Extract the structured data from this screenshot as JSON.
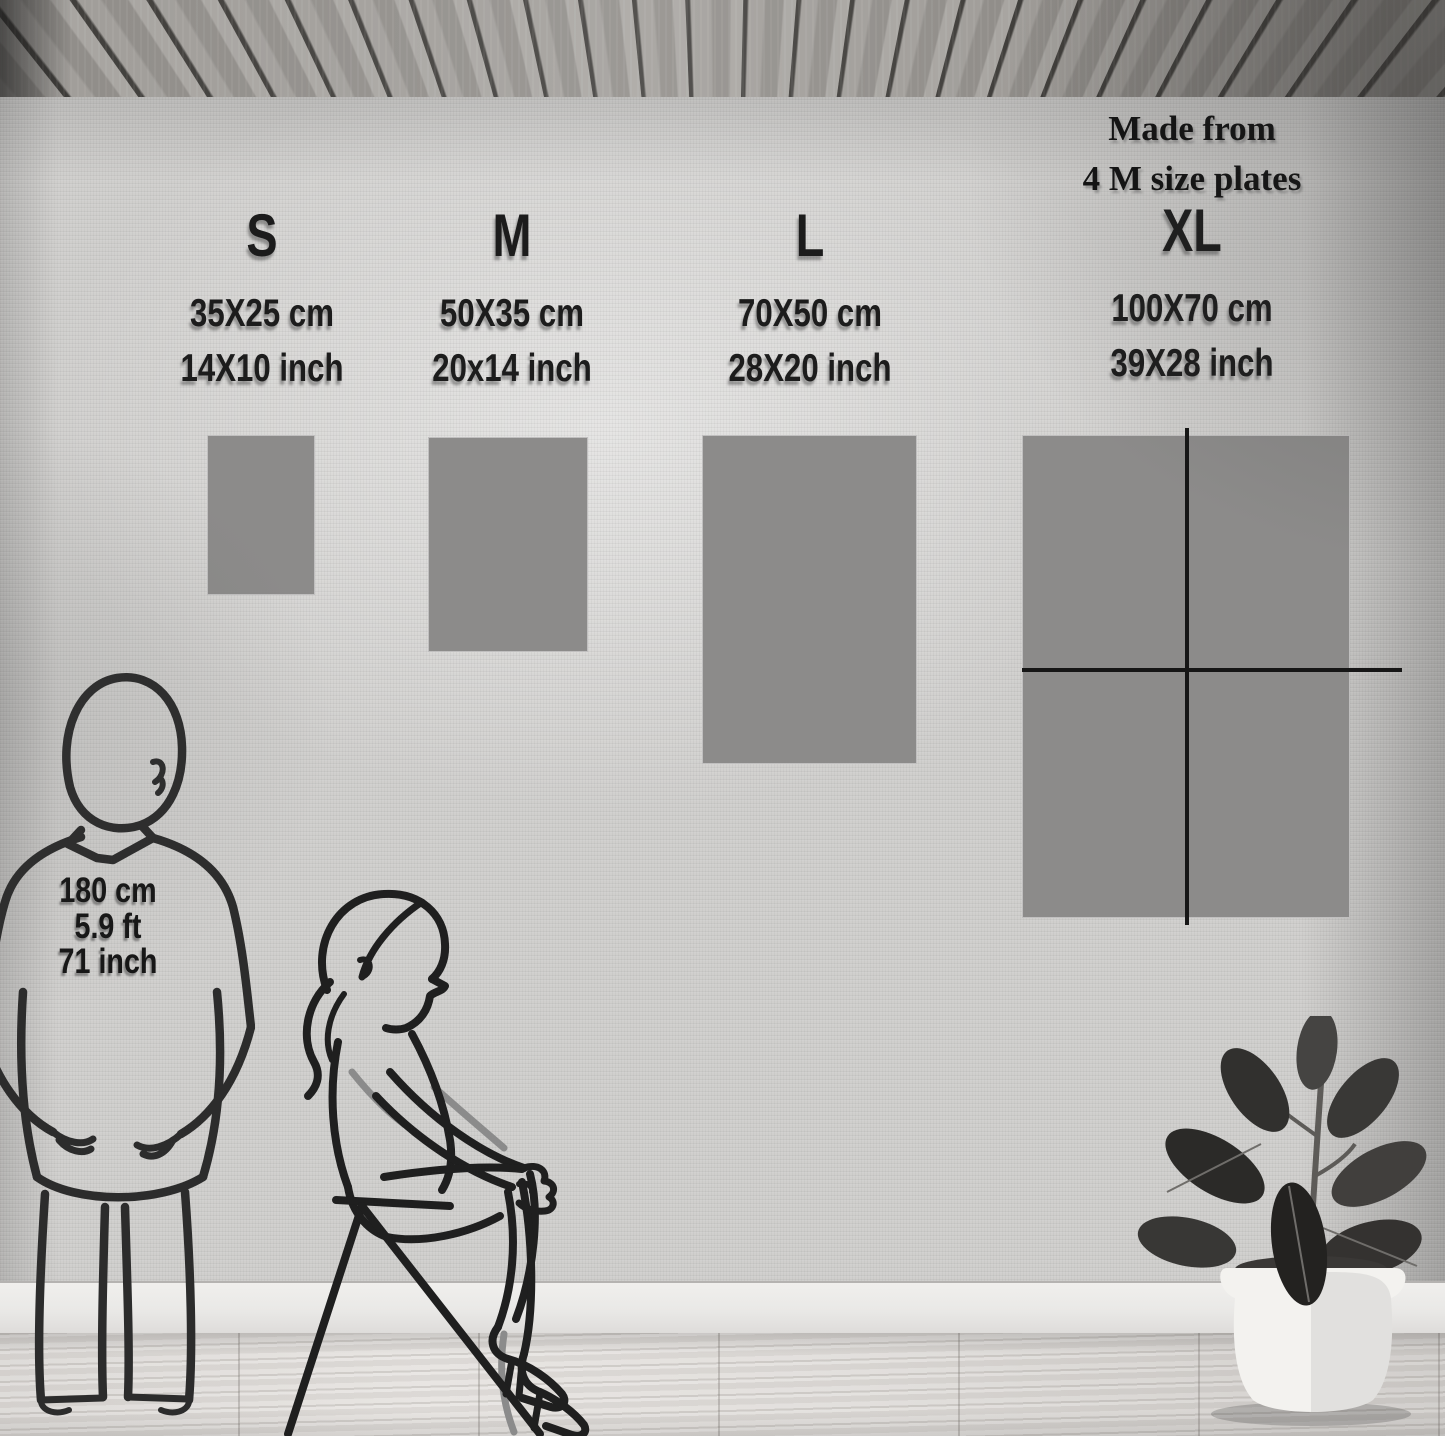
{
  "note": {
    "line1": "Made from",
    "line2": "4 M size plates"
  },
  "sizes": [
    {
      "label": "S",
      "cm": "35X25 cm",
      "inch": "14X10 inch"
    },
    {
      "label": "M",
      "cm": "50X35 cm",
      "inch": "20x14 inch"
    },
    {
      "label": "L",
      "cm": "70X50 cm",
      "inch": "28X20 inch"
    },
    {
      "label": "XL",
      "cm": "100X70  cm",
      "inch": "39X28 inch",
      "composition": "made from 4 M size plates"
    }
  ],
  "person": {
    "height_cm": "180 cm",
    "height_ft": "5.9 ft",
    "height_inch": "71 inch"
  },
  "icons": {
    "standing_man": "standing-man-line-figure",
    "sitting_woman": "sitting-woman-line-figure",
    "plant": "potted-rubber-plant",
    "ceiling": "wood-slat-ceiling"
  },
  "colors": {
    "wall": "#d0cfcd",
    "swatch_gray": "#8c8b8a",
    "divider_black": "#161616",
    "ink": "#1c1c1c",
    "pot_white": "#f3f2ef"
  }
}
